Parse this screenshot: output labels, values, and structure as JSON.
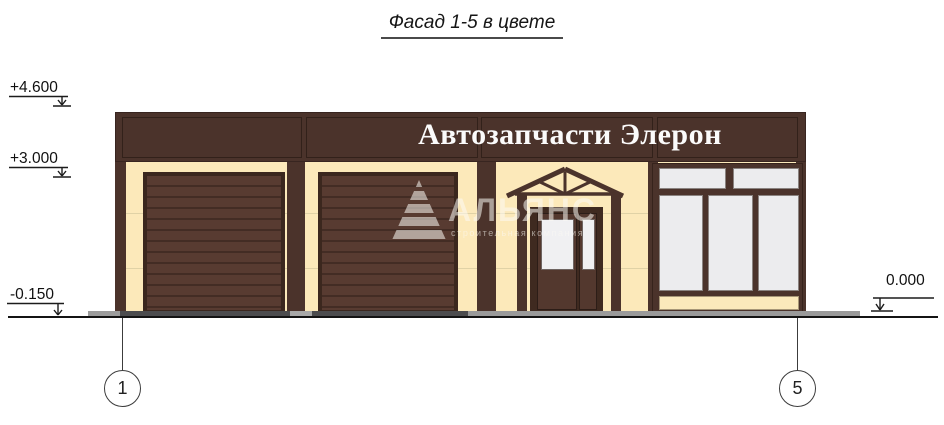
{
  "title": "Фасад 1-5 в цвете",
  "sign": "Автозапчасти Элерон",
  "elevation_marks": [
    {
      "id": "top-parapet",
      "label": "+4.600"
    },
    {
      "id": "sign-band-bottom",
      "label": "+3.000"
    },
    {
      "id": "ground-left",
      "label": "-0.150"
    },
    {
      "id": "ground-right",
      "label": "0.000"
    }
  ],
  "axis_markers": [
    {
      "label": "1"
    },
    {
      "label": "5"
    }
  ],
  "watermark": {
    "text": "АЛЬЯНС",
    "subtext": "строительная компания"
  },
  "colors": {
    "band_brown": "#4b332b",
    "wall_cream": "#fce9ba",
    "garage_door_brown": "#583b31",
    "door_frame_dark": "#3f2a20",
    "glass_light": "#ececee",
    "sidewalk_dark": "#4c4c4e",
    "sidewalk_light": "#9a9a9a",
    "line_black": "#1c1c1c",
    "sign_text_white": "#fbfbfb"
  }
}
